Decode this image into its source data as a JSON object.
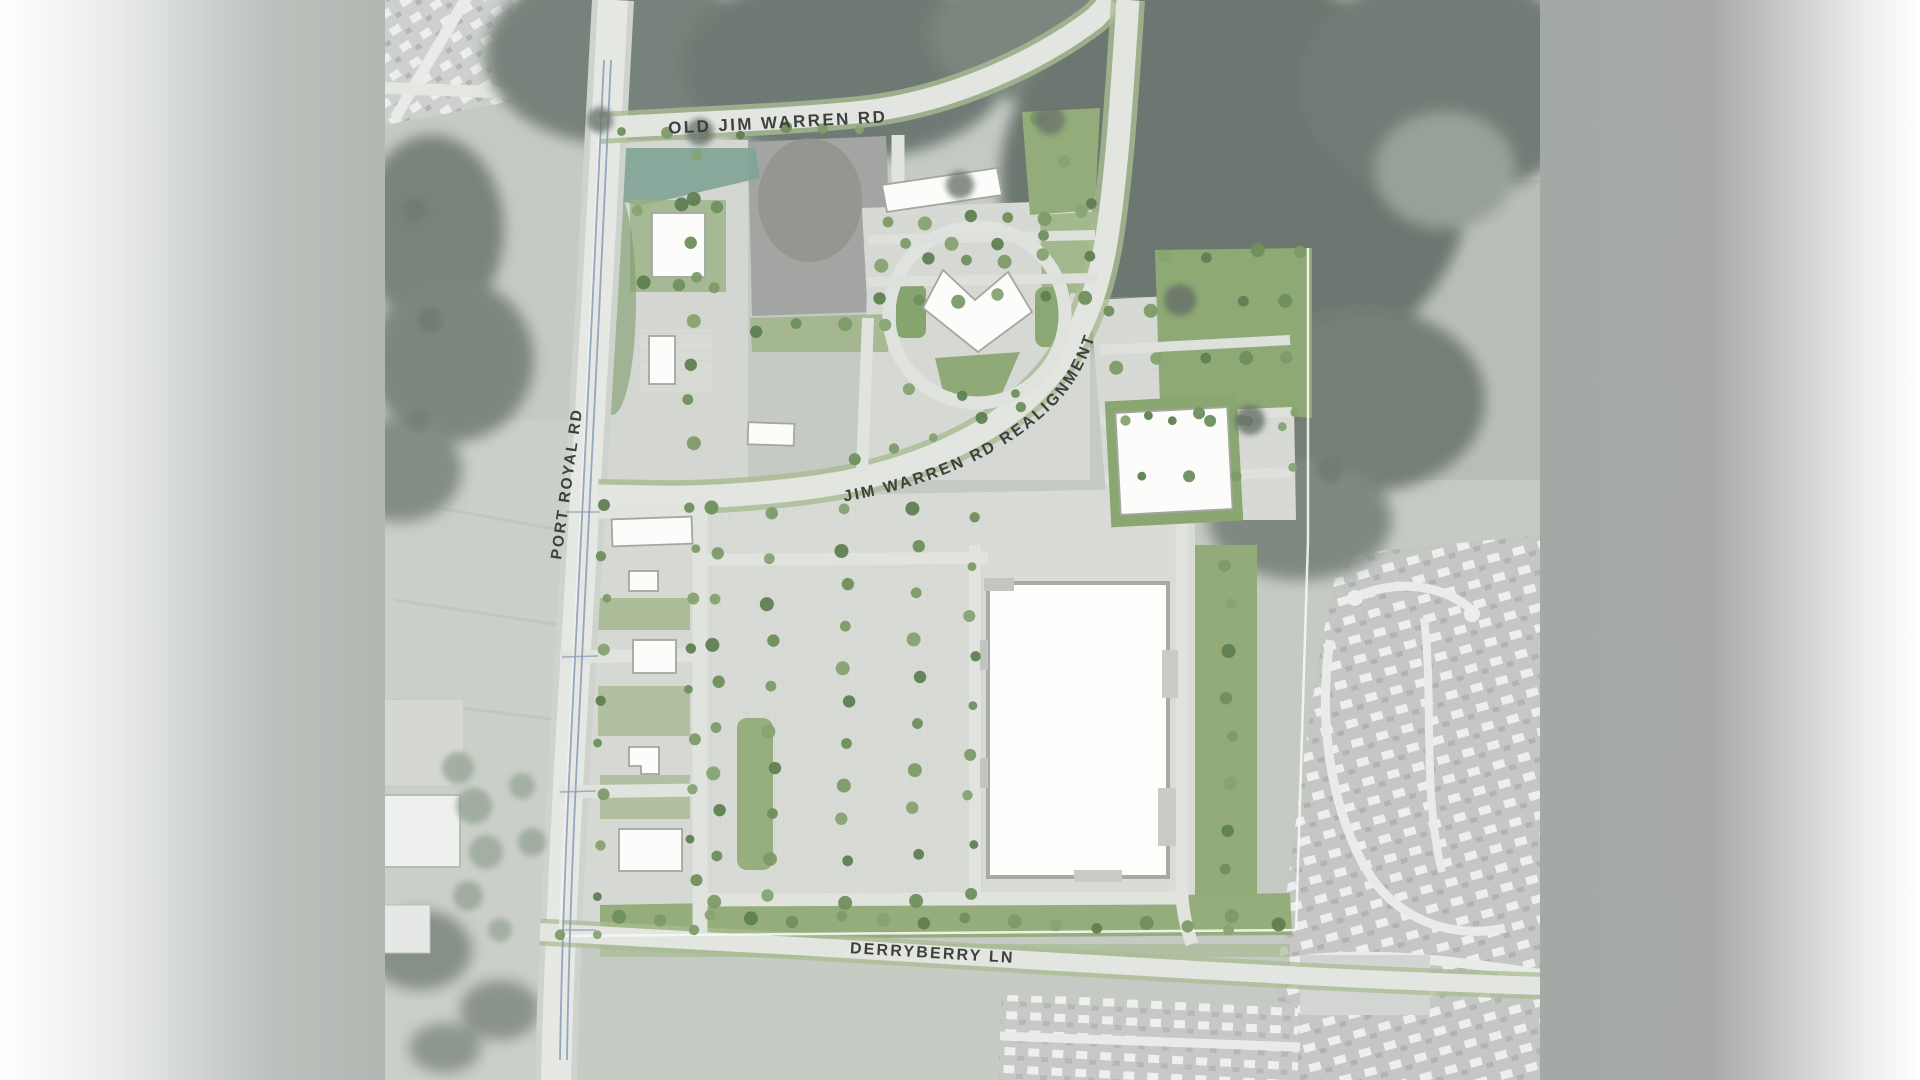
{
  "map": {
    "type": "site-plan-aerial",
    "road_labels": {
      "old_jim_warren": "OLD JIM WARREN RD",
      "port_royal": "PORT ROYAL RD",
      "jim_warren_realignment": "JIM WARREN RD REALIGNMENT",
      "derryberry": "DERRYBERRY LN"
    },
    "colors": {
      "label_ink": "#3d403d",
      "building_white": "#fcfdfb",
      "building_outline": "#a3a6a1",
      "site_pavement": "#d8dad5",
      "existing_asphalt": "#a2a5a1",
      "landscape_green": "#8fab76",
      "tree_green": "#6f8f5d",
      "forest_gray": "#6f7973",
      "road_surface": "#e3e5e1",
      "road_edge_green": "#a9bc93",
      "road_line_blue": "#8ca0b8",
      "photo_base": "#c5cac4"
    }
  }
}
